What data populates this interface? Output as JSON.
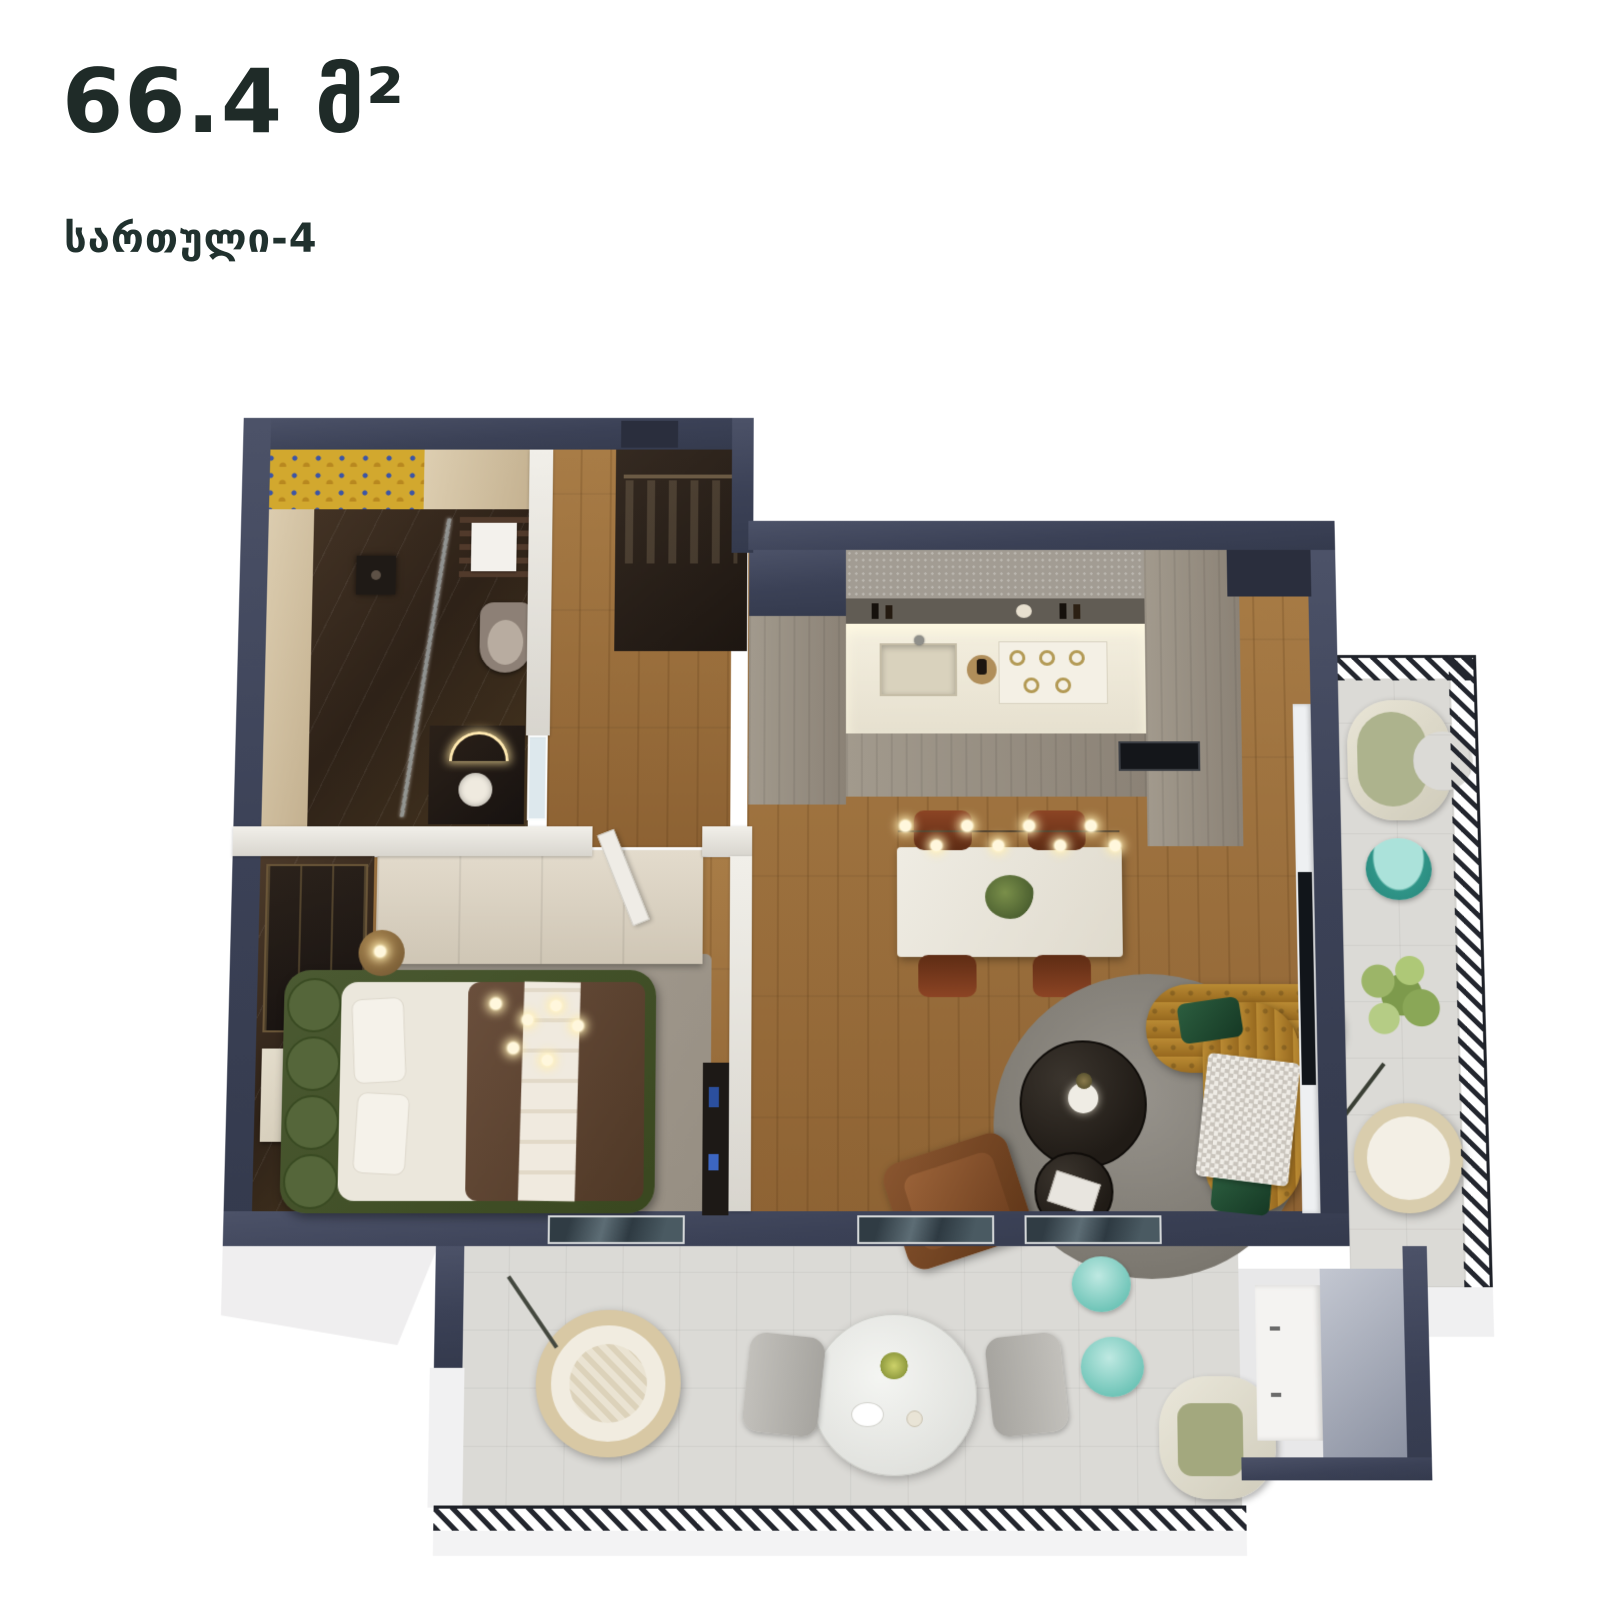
{
  "header": {
    "area_label": "66.4 მ²",
    "floor_label": "სართული-4"
  },
  "plan": {
    "type": "apartment-floor-plan-3d-top-view",
    "rooms": [
      "bathroom",
      "hallway",
      "bedroom",
      "kitchen",
      "living-dining",
      "balcony-right",
      "balcony-bottom"
    ]
  },
  "palette": {
    "text_dark": "#1f2b28",
    "wall_navy": "#3b4156",
    "wall_light": "#e7e4dd",
    "wood_floor": "#9c713c",
    "balcony_tile": "#dbdad6",
    "marble_dark": "#3a2c20",
    "mosaic_yellow": "#d2a82e",
    "mosaic_blue": "#3c55a5",
    "kitchen_counter": "#ece7d8",
    "backsplash_gray": "#a29c93",
    "rug_gray": "#87837c",
    "sofa_mustard": "#a97c2b",
    "pillow_green": "#1f4d33",
    "bed_green": "#4b5a32",
    "duvet_brown": "#5f4736",
    "dining_chair_rust": "#77381d",
    "armchair_leather": "#7b4928",
    "accent_teal": "#6cc3b6",
    "sage_green": "#adb38d",
    "rattan": "#d8c8a4",
    "railing_metal": "#23262e"
  }
}
